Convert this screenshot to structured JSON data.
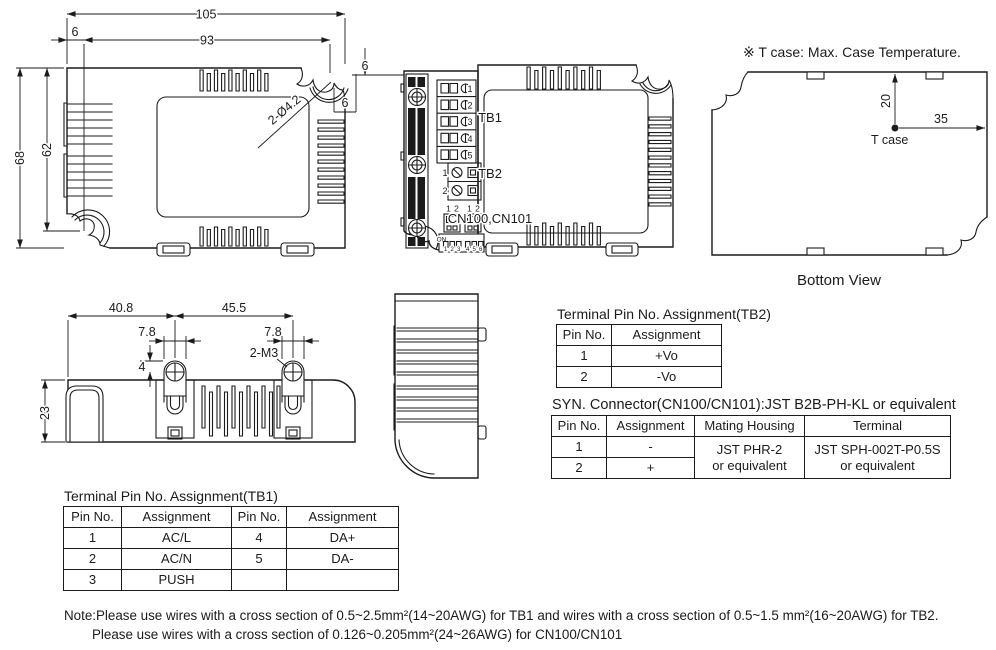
{
  "colors": {
    "line": "#1b1b1b",
    "background": "#ffffff"
  },
  "top_view": {
    "dim_105": "105",
    "dim_93": "93",
    "dim_6_left": "6",
    "dim_68": "68",
    "dim_62": "62",
    "hole_callout": "2-Ø4.2",
    "dim_6_right_v": "6",
    "dim_6_right_h": "6"
  },
  "front_view": {
    "tb1_label": "TB1",
    "tb2_label": "TB2",
    "cn_label": "CN100,CN101",
    "tb1_pins": [
      "1",
      "2",
      "3",
      "4",
      "5"
    ],
    "tb2_pins": [
      "1",
      "2"
    ],
    "cn_pins": [
      "1",
      "2",
      "1",
      "2"
    ],
    "dip_on": "ON",
    "dip_numbers": [
      "1",
      "2",
      "3",
      "4",
      "5",
      "6"
    ]
  },
  "bottom_view": {
    "note": "※ T case: Max. Case Temperature.",
    "dim_20": "20",
    "dim_35": "35",
    "tcase_label": "T case",
    "caption": "Bottom View"
  },
  "side_view": {
    "dim_40_8": "40.8",
    "dim_45_5": "45.5",
    "dim_7_8_left": "7.8",
    "dim_7_8_right": "7.8",
    "screw_callout": "2-M3",
    "dim_4": "4",
    "dim_23": "23"
  },
  "tables": {
    "tb2": {
      "title": "Terminal Pin No. Assignment(TB2)",
      "headers": [
        "Pin No.",
        "Assignment"
      ],
      "rows": [
        [
          "1",
          "+Vo"
        ],
        [
          "2",
          "-Vo"
        ]
      ]
    },
    "syn": {
      "title": "SYN. Connector(CN100/CN101):JST B2B-PH-KL or equivalent",
      "headers": [
        "Pin No.",
        "Assignment",
        "Mating Housing",
        "Terminal"
      ],
      "rows": [
        [
          "1",
          "-"
        ],
        [
          "2",
          "+"
        ]
      ],
      "mating_housing": [
        "JST PHR-2",
        "or equivalent"
      ],
      "terminal": [
        "JST SPH-002T-P0.5S",
        "or equivalent"
      ]
    },
    "tb1": {
      "title": "Terminal Pin No. Assignment(TB1)",
      "headers": [
        "Pin No.",
        "Assignment",
        "Pin No.",
        "Assignment"
      ],
      "rows": [
        [
          "1",
          "AC/L",
          "4",
          "DA+"
        ],
        [
          "2",
          "AC/N",
          "5",
          "DA-"
        ],
        [
          "3",
          "PUSH",
          "",
          ""
        ]
      ]
    }
  },
  "notes": {
    "line1": "Note:Please use wires with a cross section of 0.5~2.5mm²(14~20AWG) for TB1 and wires with a cross section of 0.5~1.5 mm²(16~20AWG) for TB2.",
    "line2": "Please use wires with a cross section of 0.126~0.205mm²(24~26AWG) for CN100/CN101"
  }
}
